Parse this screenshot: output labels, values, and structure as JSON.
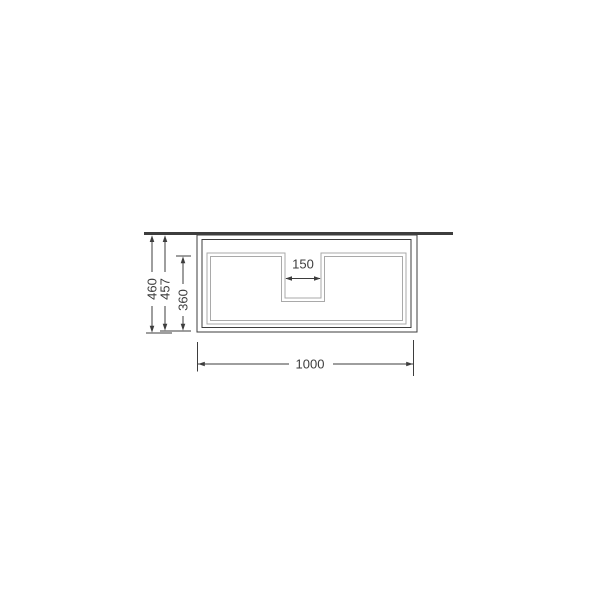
{
  "drawing": {
    "dimension_labels": {
      "overall_height": "460",
      "carcass_height": "457",
      "drawer_front_height": "360",
      "cutout_width": "150",
      "overall_width": "1000"
    },
    "colors": {
      "background": "#ffffff",
      "line": "#3d3d3d",
      "panel_line": "#a9a9a9",
      "text": "#3d3d3d"
    }
  }
}
